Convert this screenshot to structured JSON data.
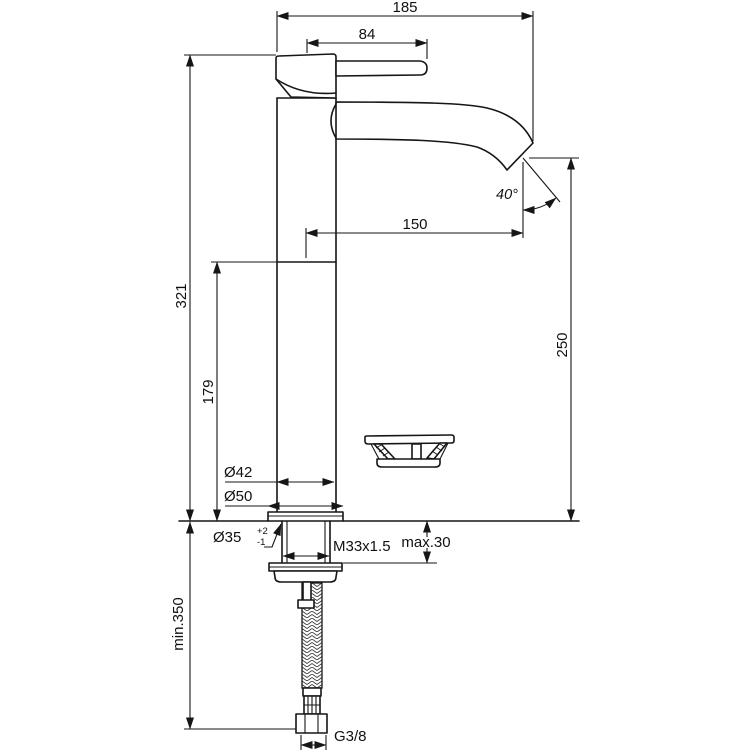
{
  "dims": {
    "overall_width": "185",
    "lever_length": "84",
    "spout_reach": "150",
    "spout_angle": "40°",
    "total_height": "321",
    "spout_base_height": "179",
    "outlet_height": "250",
    "body_diameter": "Ø42",
    "base_diameter": "Ø50",
    "hole_diameter": "Ø35",
    "hole_tol_plus": "+2",
    "hole_tol_minus": "-1",
    "shank_thread": "M33x1.5",
    "max_deck_thickness": "max.30",
    "min_hose_clearance": "min.350",
    "hose_connection": "G3/8"
  }
}
